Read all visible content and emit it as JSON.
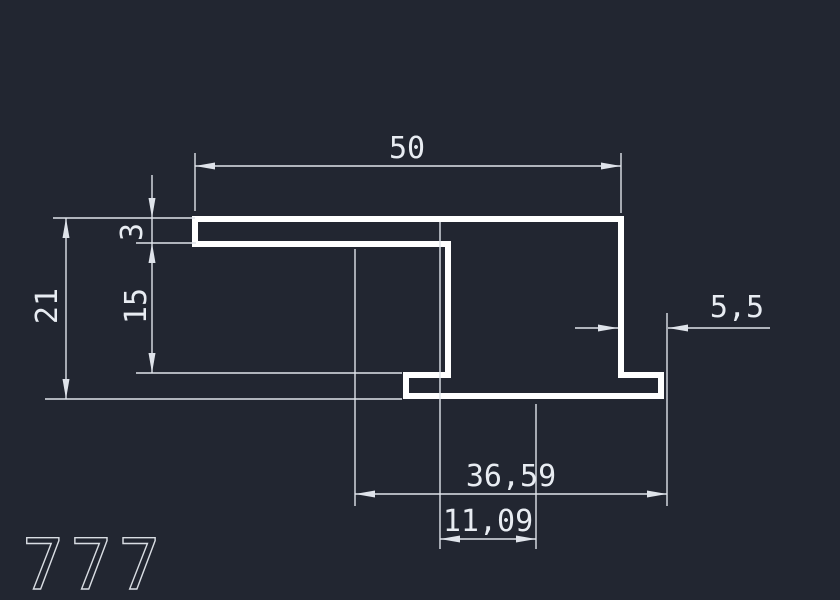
{
  "drawing": {
    "colors": {
      "background": "#222631",
      "profile": "#ffffff",
      "dimension": "#dfe3ea",
      "text": "#e8ecf2"
    },
    "sheet_label": "777",
    "dimensions": {
      "top_width": "50",
      "flange_thickness": "3",
      "inner_height": "15",
      "total_height": "21",
      "foot_width": "5,5",
      "bottom_width": "36,59",
      "web_offset": "11,09"
    }
  }
}
